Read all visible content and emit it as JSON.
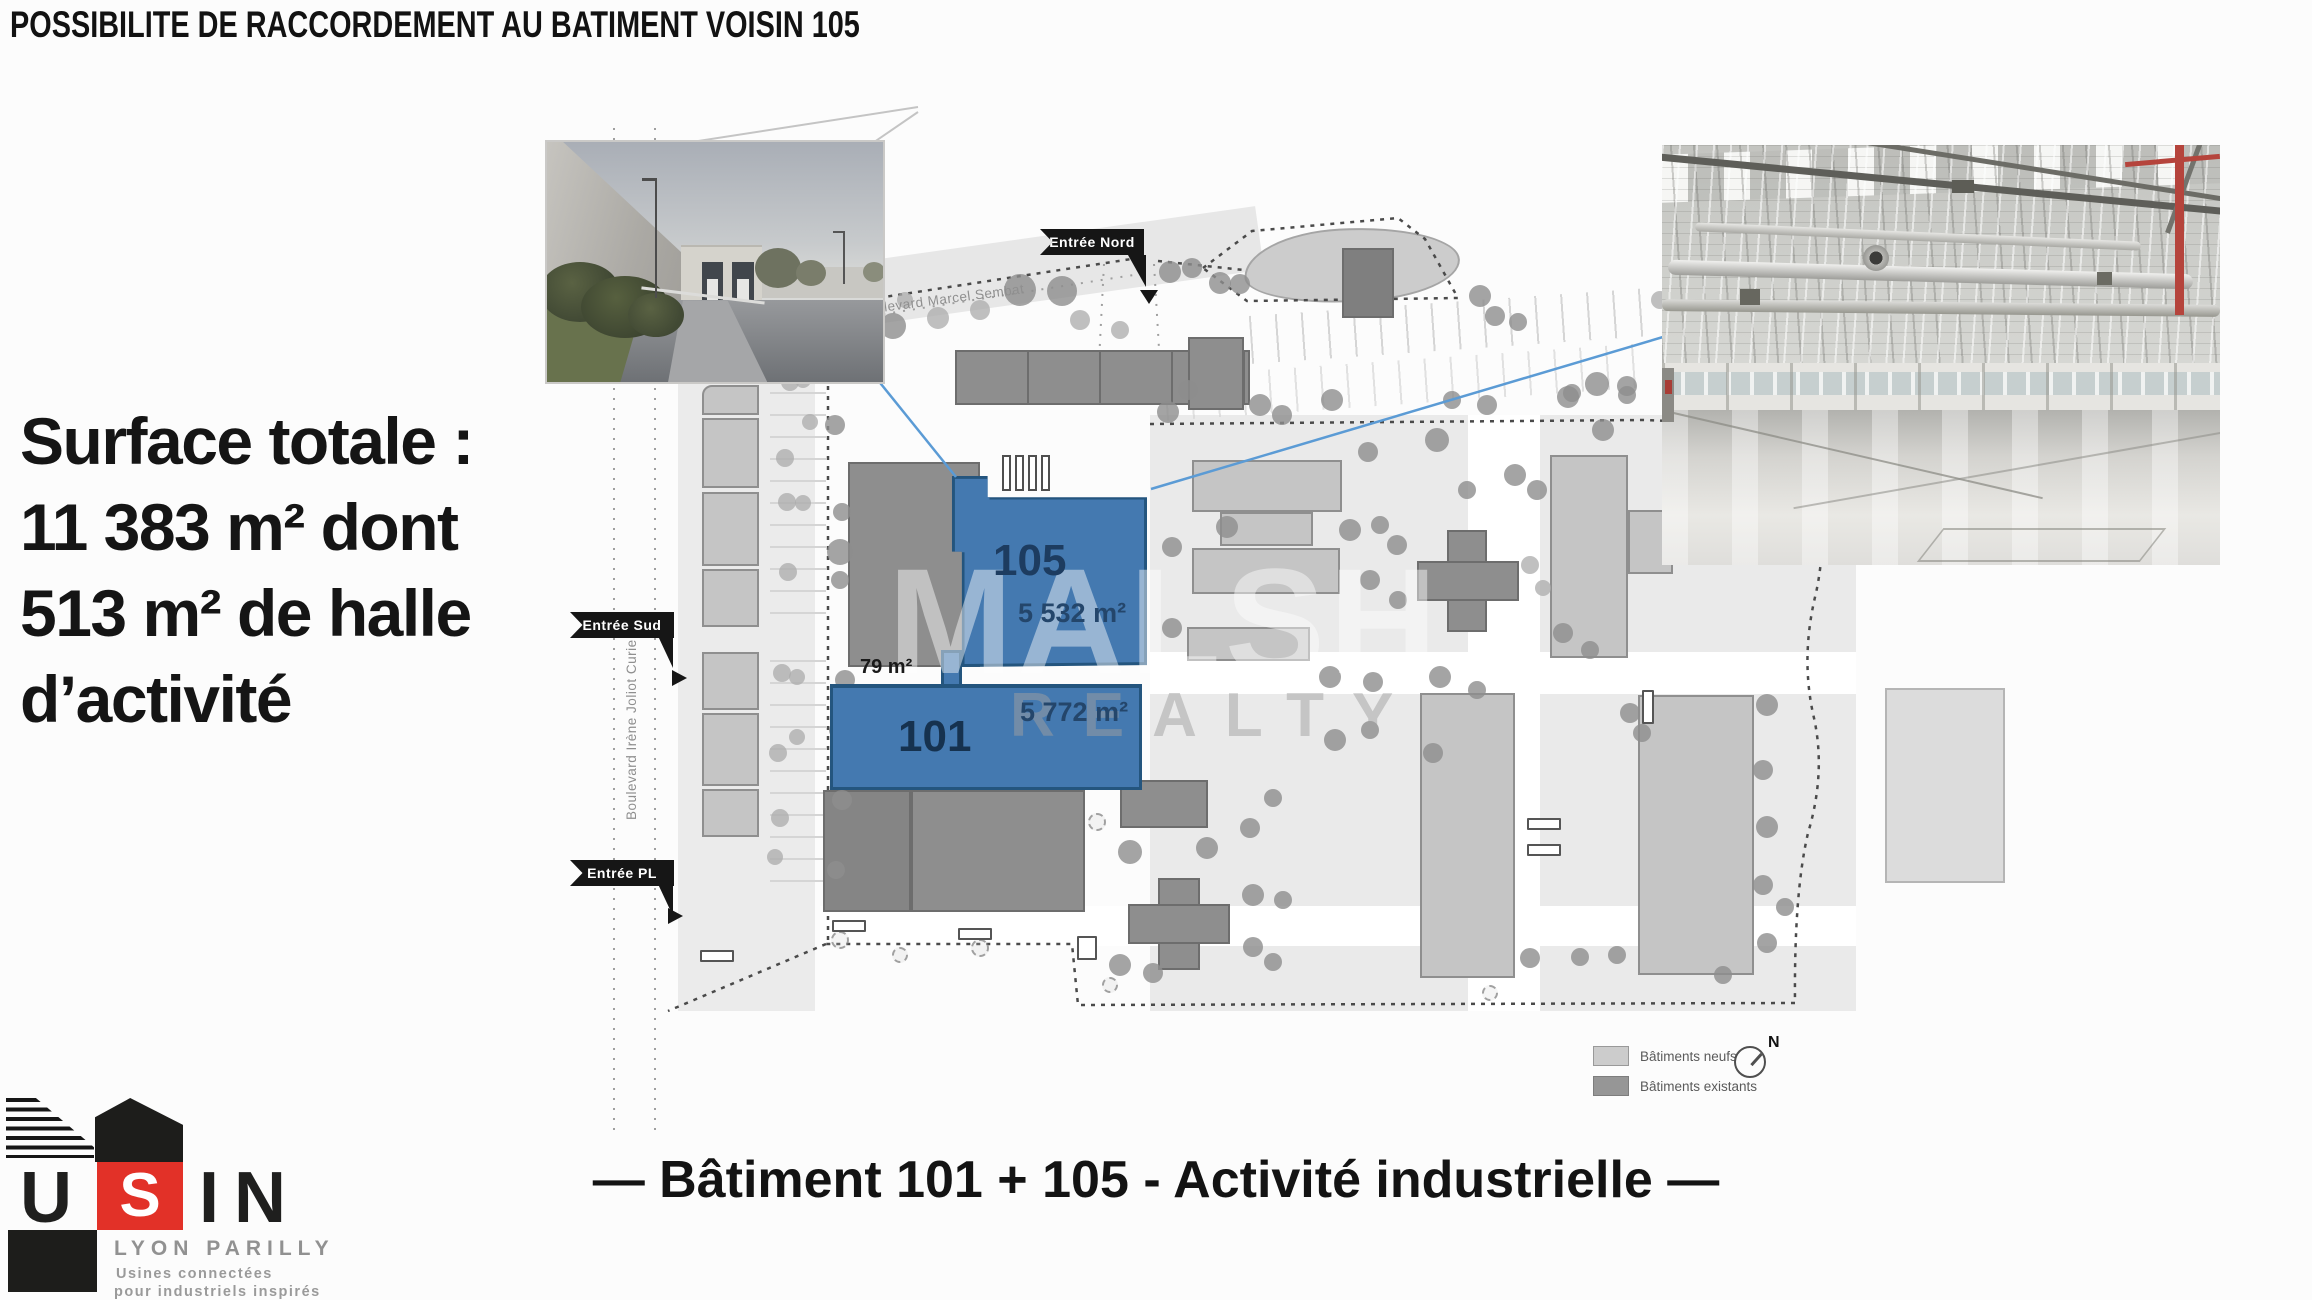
{
  "title": "POSSIBILITE DE RACCORDEMENT AU BATIMENT VOISIN 105",
  "surface_note": {
    "lines": [
      "Surface totale :",
      "11 383 m² dont",
      "513 m² de halle",
      "d’activité"
    ]
  },
  "caption": "— Bâtiment 101 + 105 - Activité industrielle —",
  "site_plan": {
    "highlighted_buildings": [
      {
        "label": "105",
        "area": "5 532 m²"
      },
      {
        "label": "101",
        "area": "5 772 m²"
      }
    ],
    "connector_area": "79 m²",
    "entrances": {
      "north": "Entrée Nord",
      "south": "Entrée Sud",
      "pl": "Entrée PL"
    },
    "streets": {
      "marcel_sembat": "Boulevard Marcel Sembat",
      "joliot_curie": "Boulevard Irène Joliot Curie"
    },
    "legend": {
      "new_buildings": "Bâtiments neufs",
      "existing_buildings": "Bâtiments existants"
    },
    "compass_north": "N",
    "watermark": {
      "line1": "MALSH",
      "line2": "REALTY"
    },
    "colors": {
      "highlight_fill": "#4479B0",
      "highlight_border": "#24557E",
      "new_building": "#C5C5C5",
      "existing_building": "#8E8E8E"
    }
  },
  "logo": {
    "letters": [
      "U",
      "S",
      "I",
      "N"
    ],
    "location": "LYON PARILLY",
    "tagline1": "Usines connectées",
    "tagline2": "pour industriels inspirés",
    "accent_color": "#E23128"
  }
}
